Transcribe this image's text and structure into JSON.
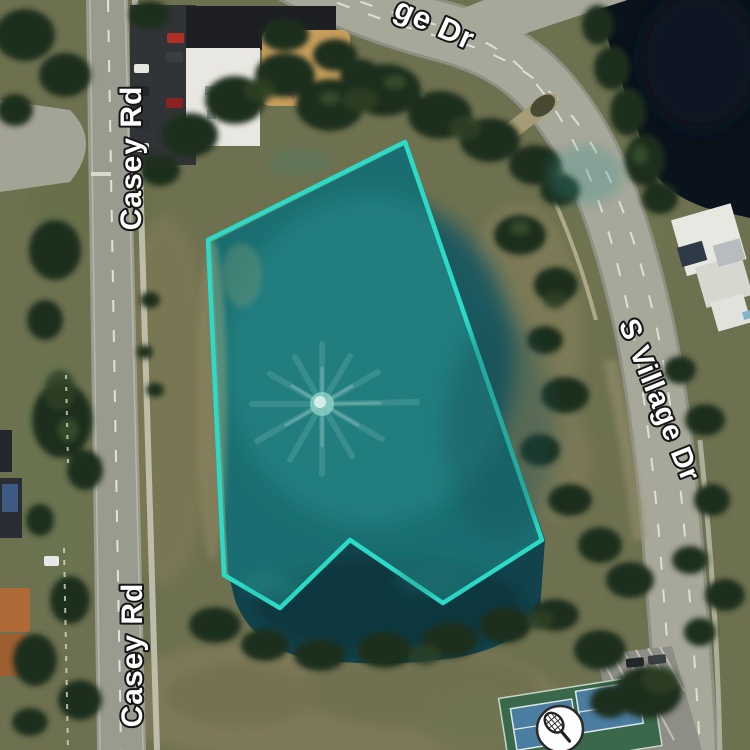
{
  "map": {
    "view": "satellite-aerial",
    "parcel": {
      "points": "405,142 208,240 224,575 280,608 350,540 443,603 542,540",
      "fill_color": "rgba(45,212,198,0.30)",
      "stroke_color": "#2BDBC8",
      "feature": "pond-with-fountain"
    },
    "road_labels": {
      "top_partial": "ge Dr",
      "left_upper": "Casey Rd",
      "left_lower": "Casey Rd",
      "right": "S Village Dr"
    },
    "poi": {
      "tennis_icon": "tennis-racket"
    }
  }
}
